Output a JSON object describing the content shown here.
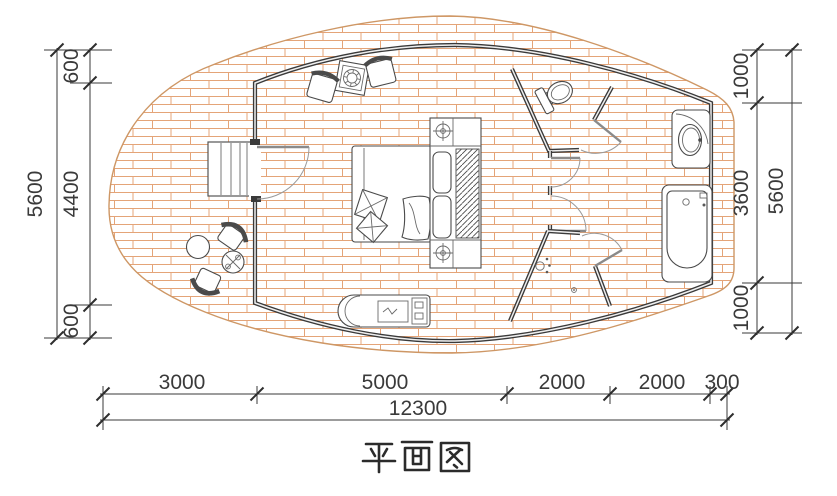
{
  "title": {
    "text": "平面图"
  },
  "dimensions": {
    "left": {
      "total": "5600",
      "segments": [
        "600",
        "4400",
        "600"
      ]
    },
    "right": {
      "total": "5600",
      "segments": [
        "1000",
        "3600",
        "1000"
      ]
    },
    "bottom": {
      "total": "12300",
      "segments": [
        "3000",
        "5000",
        "2000",
        "2000",
        "300"
      ]
    }
  },
  "colors": {
    "wall": "#3a3a3a",
    "brick_line": "#e4a478",
    "deck_edge": "#ce9765",
    "dimension_text": "#3a3a3a"
  },
  "icons": [
    "deck-icon",
    "stairs-icon",
    "entry-door-icon",
    "bed-icon",
    "pillow-icon",
    "wardrobe-hanger-icon",
    "bedside-lamp-icon",
    "armchair-icon",
    "coffee-table-icon",
    "deck-chair-icon",
    "deck-table-icon",
    "bench-icon",
    "toilet-icon",
    "shower-head-icon",
    "floor-drain-icon",
    "sink-icon",
    "bathtub-icon"
  ]
}
